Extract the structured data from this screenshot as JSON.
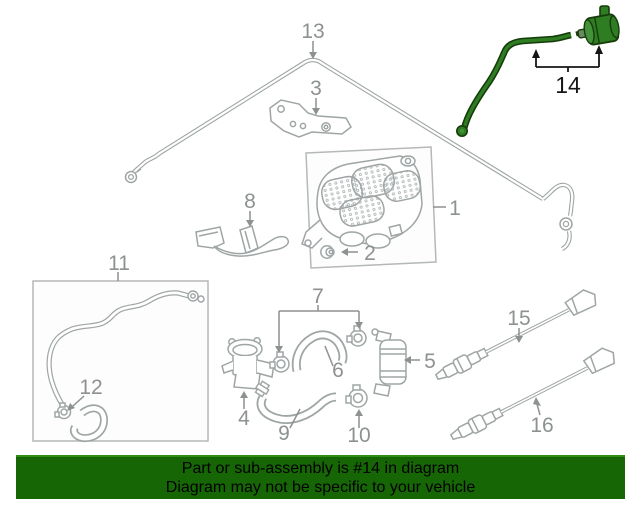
{
  "diagram": {
    "highlighted_part": "14",
    "labels": {
      "p1": "1",
      "p2": "2",
      "p3": "3",
      "p4": "4",
      "p5": "5",
      "p6": "6",
      "p7": "7",
      "p8": "8",
      "p9": "9",
      "p10": "10",
      "p11": "11",
      "p12": "12",
      "p13": "13",
      "p14": "14",
      "p15": "15",
      "p16": "16"
    },
    "colors": {
      "line": "#9fa5a5",
      "label": "#8d9191",
      "highlight_fill": "#2e7d22",
      "highlight_stroke": "#163c0b",
      "callout": "#161616"
    }
  },
  "banner": {
    "line1": "Part or sub-assembly is #14 in diagram",
    "line2": "Diagram may not be specific to your vehicle",
    "background": "#176606",
    "text_color": "#000000"
  }
}
